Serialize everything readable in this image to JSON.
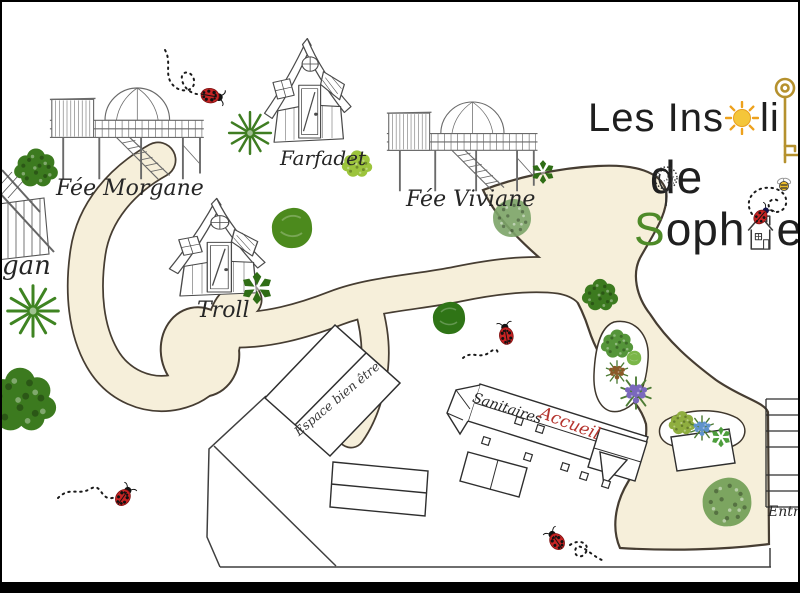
{
  "logo": {
    "line1_pre": "Les Ins",
    "line1_post": "li",
    "line2": "de",
    "line3_s": "S",
    "line3_mid": "oph",
    "line3_end": "e"
  },
  "cabins": {
    "korrigan_partial": "gan",
    "fee_morgane": "Fée Morgane",
    "farfadet": "Farfadet",
    "fee_viviane": "Fée Viviane",
    "troll": "Troll"
  },
  "buildings": {
    "espace_bien_etre": "Espace bien être",
    "sanitaires": "Sanitaires",
    "accueil": "Accueil"
  },
  "map": {
    "entree": "Entrée"
  },
  "colors": {
    "path_fill": "#f6efda",
    "path_outline": "#463d32",
    "accueil_red": "#b5342e",
    "logo_green": "#4e8a28",
    "key_gold": "#b5912e",
    "sun_yellow": "#f4c63a",
    "ladybug_red": "#c62323",
    "bush_green": "#3c7a1f"
  }
}
